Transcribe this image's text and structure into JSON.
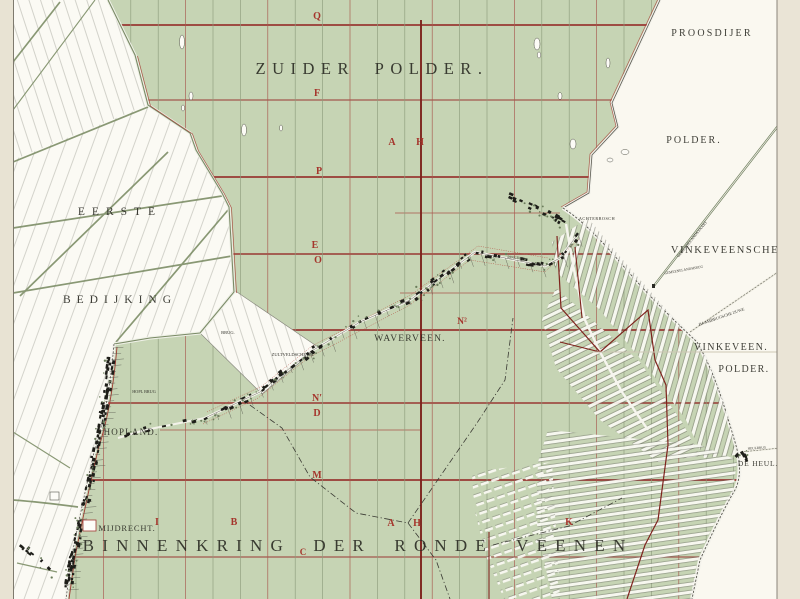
{
  "map": {
    "regions": {
      "zuider_polder": "ZUIDER POLDER.",
      "proosdijer": "PROOSDIJER",
      "proosdijer_polder": "POLDER.",
      "vinkeveensche": "VINKEVEENSCHE",
      "vinkeveen": "VINKEVEEN.",
      "vinkeveen_polder": "POLDER.",
      "eerste": "EERSTE",
      "bedijking": "BEDIJKING",
      "binnenkring": "BINNENKRING DER RONDE VEENEN"
    },
    "places": {
      "waverveen": "WAVERVEEN.",
      "mijdrecht": "MIJDRECHT.",
      "hopland": "HOPLAND.",
      "de_heul": "DE HEUL.",
      "achterbosch": "ACHTERBOSCH",
      "brug": "BRUG.",
      "zultveldsche_brug": "ZULTVELDSCHE BR.",
      "hopland_brug": "HOPL BRUG",
      "heulbrug": "HEULBRUG",
      "ringdijk": "RINGDIJK"
    },
    "roads": {
      "gemeenelandsvaart": "GEMEENELANDSVAART",
      "gemeenelandsbrug": "GEMEENELANDSBRUG",
      "baambrugsche_zuwe": "BAAMBRUGSCHE ZUWE"
    },
    "section_letters": {
      "q": "Q",
      "f": "F",
      "p": "P",
      "e": "E",
      "o": "O",
      "n_accent": "N′",
      "d": "D",
      "m": "M",
      "c": "C",
      "a_north": "A",
      "h_north": "H",
      "a_south": "A",
      "h_south": "H",
      "i": "I",
      "b": "B",
      "k": "K",
      "n_sup": "N²"
    },
    "colors": {
      "polder_green": "#c6d4b4",
      "grid_red": "#993833",
      "boundary_dark_red": "#7e221c",
      "letter_red": "#a5352c",
      "paper_white": "#fbfaf4",
      "page_beige": "#e8e3d3",
      "road_olive": "#7d8e67",
      "ink_black": "#26261f"
    }
  }
}
